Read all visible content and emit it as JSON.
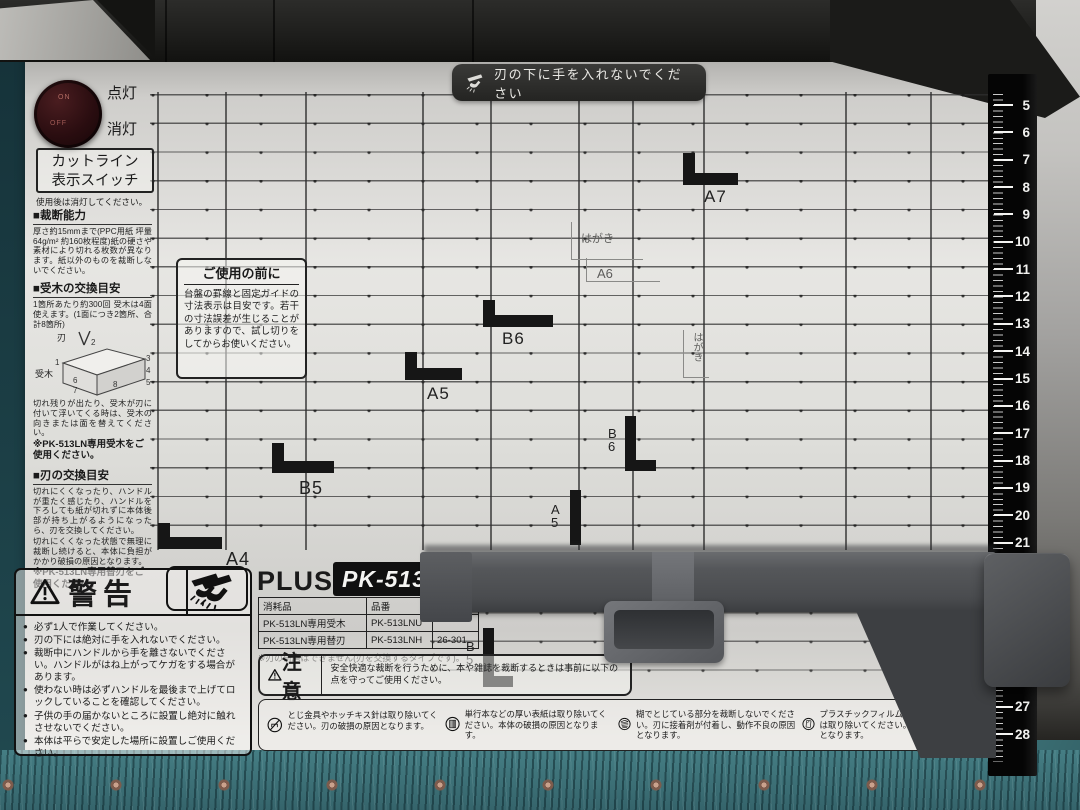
{
  "machine": {
    "brand": "PLUS",
    "model": "PK-513L",
    "banner": "刃の下に手を入れないでください"
  },
  "cutline_switch": {
    "on": "ON",
    "off": "OFF",
    "label_on": "点灯",
    "label_off": "消灯",
    "box_line1": "カットライン",
    "box_line2": "表示スイッチ",
    "note": "使用後は消灯してください。"
  },
  "sections": {
    "capacity": {
      "title": "■裁断能力",
      "body": "厚さ約15mmまで(PPC用紙 坪量64g/m² 約160枚程度)紙の硬さや素材により切れる枚数が異なります。紙以外のものを裁断しないでください。"
    },
    "ukigi": {
      "title": "■受木の交換目安",
      "body": "1箇所あたり約300回 受木は4面使えます。(1面につき2箇所、合計8箇所)",
      "diagram": {
        "blade": "刃",
        "wood": "受木",
        "numbers": [
          "1",
          "2",
          "3",
          "4",
          "5",
          "6",
          "7",
          "8"
        ]
      },
      "body2": "切れ残りが出たり、受木が刃に付いて浮いてくる時は、受木の向きまたは面を替えてください。",
      "note": "※PK-513LN専用受木をご使用ください。"
    },
    "blade": {
      "title": "■刃の交換目安",
      "body": "切れにくくなったり、ハンドルが重たく感じたり、ハンドルを下ろしても紙が切れずに本体後部が持ち上がるようになったら、刃を交換してください。",
      "body2": "切れにくくなった状態で無理に裁断し続けると、本体に負担がかかり破損の原因となります。",
      "note": "※PK-513LN専用替刃をご使用ください。"
    }
  },
  "before_use": {
    "title": "ご使用の前に",
    "body": "台盤の罫線と固定ガイドの寸法表示は目安です。若干の寸法誤差が生じることがありますので、試し切りをしてからお使いください。"
  },
  "warning": {
    "title": "警告",
    "items": [
      "必ず1人で作業してください。",
      "刃の下には絶対に手を入れないでください。",
      "裁断中にハンドルから手を離さないでください。ハンドルがはね上がってケガをする場合があります。",
      "使わない時は必ずハンドルを最後まで上げてロックしていることを確認してください。",
      "子供の手の届かないところに設置し絶対に触れさせないでください。",
      "本体は平らで安定した場所に設置しご使用ください。"
    ]
  },
  "caution": {
    "title": "注意",
    "intro": "安全快適な裁断を行うために、本や雑誌を裁断するときは事前に以下の点を守ってご使用ください。",
    "items": [
      {
        "icon": "no-staples-icon",
        "text": "とじ金具やホッチキス針は取り除いてください。刃の破損の原因となります。"
      },
      {
        "icon": "thick-cover-book-icon",
        "text": "単行本などの厚い表紙は取り除いてください。本体の破損の原因となります。"
      },
      {
        "icon": "glue-binding-icon",
        "text": "糊でとじている部分を裁断しないでください。刃に接着剤が付着し、動作不良の原因となります。"
      },
      {
        "icon": "plastic-film-icon",
        "text": "プラスチックフィルムなど紙以外のものは取り除いてください。刃の破損の原因となります。"
      }
    ]
  },
  "parts_table": {
    "headers": [
      "消耗品",
      "品番",
      ""
    ],
    "rows": [
      [
        "PK-513LN専用受木",
        "PK-513LNU",
        ""
      ],
      [
        "PK-513LN専用替刃",
        "PK-513LNH",
        "26-301"
      ]
    ],
    "note": "※刃の研磨はできません(刃を交換するタイプです)。"
  },
  "size_markers": {
    "a7": "A7",
    "hagaki": "はがき",
    "a6": "A6",
    "b6": "B6",
    "a5": "A5",
    "b5": "B5",
    "a4": "A4",
    "b6_v": "B6",
    "a5_v": "A5",
    "b5_v": "B5",
    "hagaki_v": "はがき"
  },
  "ruler": {
    "start": 5,
    "end": 28
  },
  "colors": {
    "carpet": "#3f767c",
    "base": "#e7e6e3",
    "housing": "#1d1d1b",
    "ruler_black": "#050505",
    "fence_gray": "#55575a",
    "switch_maroon": "#2a0d10"
  }
}
